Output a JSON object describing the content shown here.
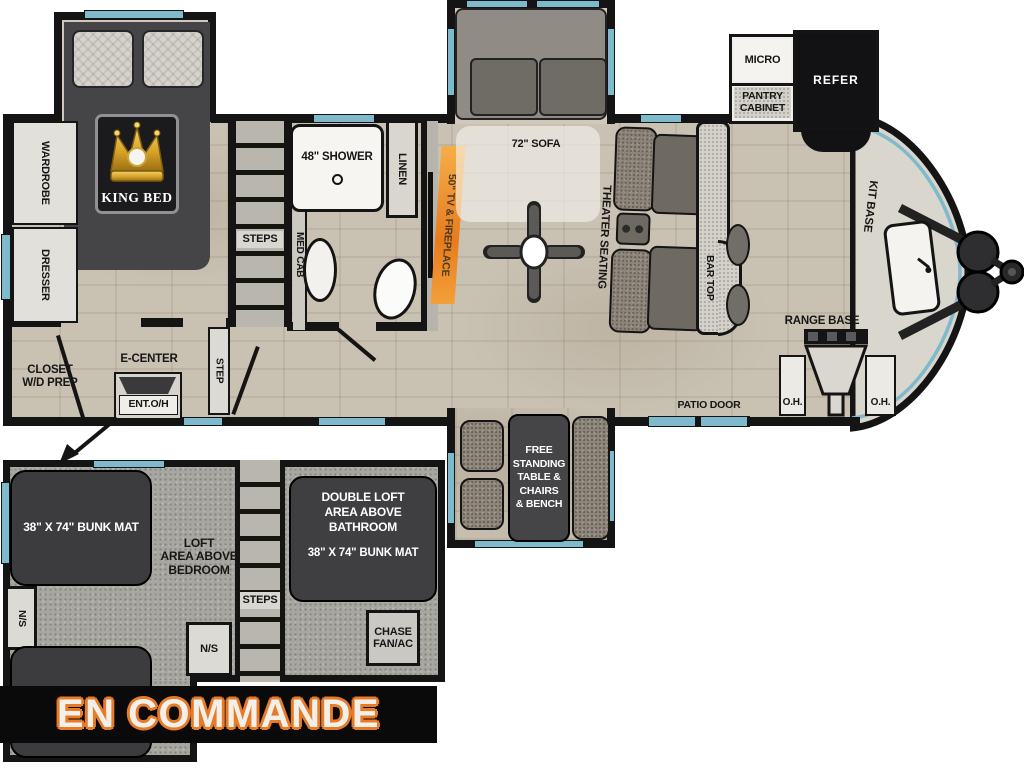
{
  "status_banner": {
    "text": "EN COMMANDE"
  },
  "colors": {
    "floor_tile": "#c9c1b2",
    "wall": "#141414",
    "window_blue": "#7fb9cc",
    "loft_floor": "#a8a6a0",
    "mattress_dark": "#3c3c3e",
    "fireplace_orange": "#ee8a2b",
    "banner_text": "#f3f0ea",
    "banner_outline": "#e87b28",
    "crown_gold": "#d9a429"
  },
  "main_floorplan": {
    "bedroom": {
      "king_bed_label": "KING BED",
      "wardrobe_label": "WARDROBE",
      "dresser_label": "DRESSER",
      "closet_label": "CLOSET\nW/D PREP",
      "e_center_label": "E-CENTER",
      "ent_oh_label": "ENT.O/H",
      "step_label": "STEP"
    },
    "bathroom": {
      "shower_label": "48\" SHOWER",
      "linen_label": "LINEN",
      "med_cab_label": "MED CAB",
      "steps_label": "STEPS"
    },
    "living_area": {
      "tv_label": "50\" TV",
      "fireplace_label": "& FIREPLACE",
      "sofa_label": "72\" SOFA",
      "theater_seating_label": "THEATER SEATING",
      "bar_top_label": "BAR TOP"
    },
    "kitchen": {
      "micro_label": "MICRO",
      "pantry_label": "PANTRY\nCABINET",
      "refer_label": "REFER",
      "kit_base_label": "KIT BASE",
      "range_base_label": "RANGE BASE",
      "oh_left_label": "O.H.",
      "oh_right_label": "O.H.",
      "patio_door_label": "PATIO DOOR"
    },
    "dinette": {
      "table_label": "FREE\nSTANDING\nTABLE &\nCHAIRS\n& BENCH"
    }
  },
  "loft_floorplan": {
    "bunk_mat_label": "38\" X 74\" BUNK MAT",
    "loft_area_label": "LOFT\nAREA ABOVE\nBEDROOM",
    "ns_left_label": "N/S",
    "ns_right_label": "N/S",
    "steps_label": "STEPS",
    "double_loft_label": "DOUBLE LOFT\nAREA ABOVE\nBATHROOM",
    "double_loft_bunk_label": "38\" X 74\" BUNK MAT",
    "chase_label": "CHASE\nFAN/AC"
  }
}
